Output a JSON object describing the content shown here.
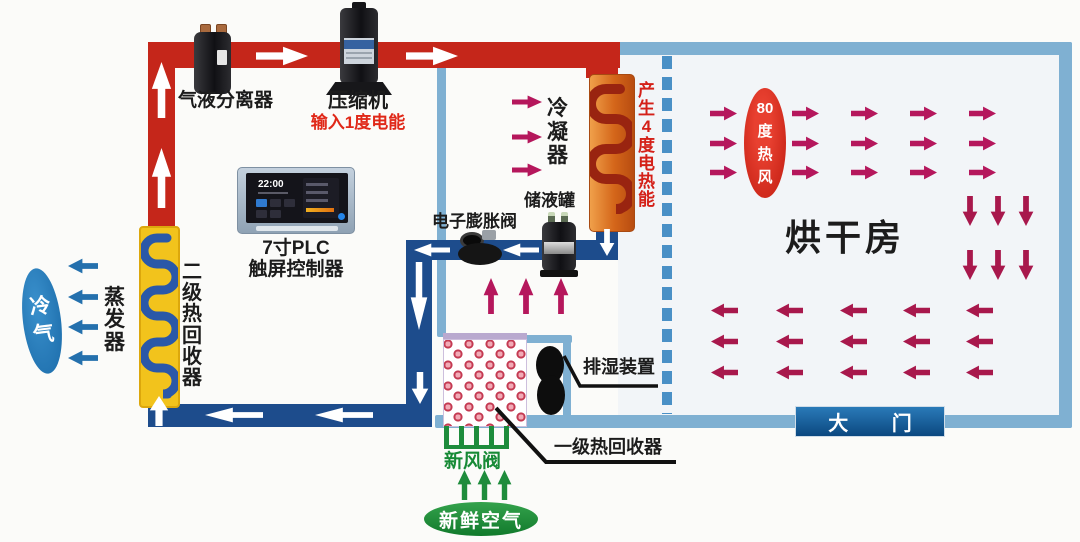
{
  "labels": {
    "separator": "气液分离器",
    "compressor": "压缩机",
    "power_input": "输入1度电能",
    "plc": "7寸PLC\n触屏控制器",
    "condenser": "冷\n凝\n器",
    "heat_gen": "产\n生\n4\n度\n电\n热\n能",
    "receiver": "储液罐",
    "expansion_valve": "电子膨胀阀",
    "evaporator": "蒸\n发\n器",
    "stage2_recovery": "二\n级\n热\n回\n收\n器",
    "cold_air": "冷\n气",
    "drying_room": "烘干房",
    "hot_air": "80\n度\n热\n风",
    "gate": "大 门",
    "dehumidifier": "排湿装置",
    "stage1_recovery": "一级热回收器",
    "fresh_air_valve": "新风阀",
    "fresh_air": "新鲜空气"
  },
  "plc": {
    "time": "22:00"
  },
  "colors": {
    "hot_pipe": "#c5261a",
    "cold_pipe": "#1d4c8c",
    "wall_blue": "#7fb0d2",
    "dashed_blue": "#4a90c6",
    "hot_arrow": "#b5175c",
    "return_arrow": "#a8184c",
    "cold_arrow": "#2470ad",
    "green": "#1e8c3c",
    "alert_red": "#e02818",
    "gate_blue": "#0b4880",
    "recovery_yellow": "#f2c31c",
    "condenser_orange": "#d4661a"
  }
}
